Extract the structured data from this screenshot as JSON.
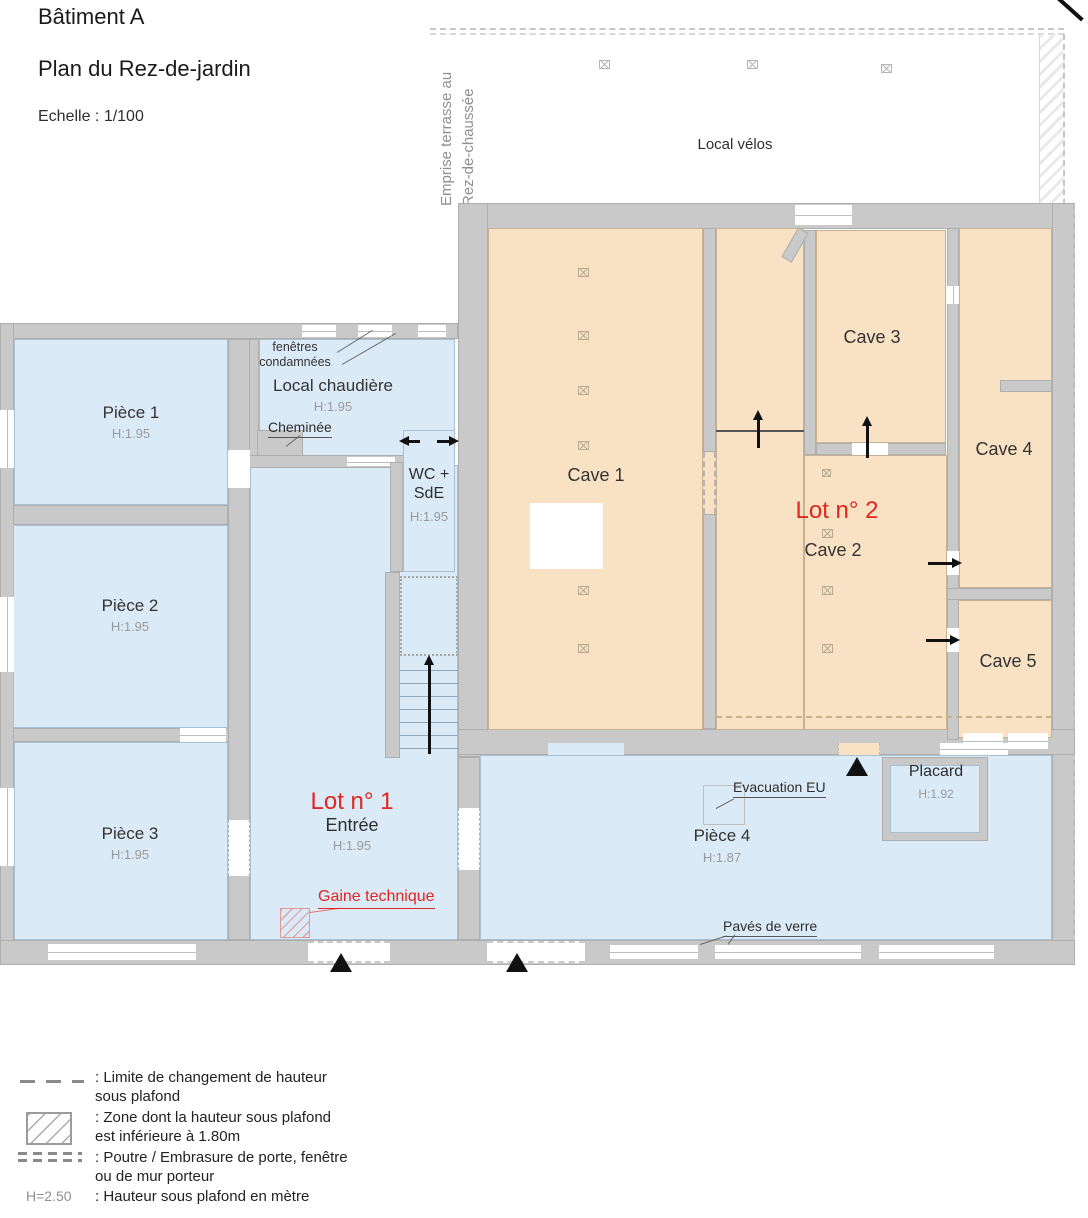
{
  "title": {
    "line1": "Bâtiment A",
    "line2": "Plan du Rez-de-jardin",
    "scale": "Echelle : 1/100"
  },
  "terrace": {
    "edge_label": "Emprise terrasse au\nRez-de-chaussée",
    "room_label": "Local vélos"
  },
  "lots": {
    "lot1": "Lot n° 1",
    "lot2": "Lot n° 2"
  },
  "rooms": {
    "piece1": {
      "name": "Pièce 1",
      "height": "H:1.95"
    },
    "piece2": {
      "name": "Pièce 2",
      "height": "H:1.95"
    },
    "piece3": {
      "name": "Pièce 3",
      "height": "H:1.95"
    },
    "piece4": {
      "name": "Pièce 4",
      "height": "H:1.87"
    },
    "local_chaudiere": {
      "name": "Local chaudière",
      "height": "H:1.95"
    },
    "wc": {
      "name": "WC +\nSdE",
      "height": "H:1.95"
    },
    "entree": {
      "name": "Entrée",
      "height": "H:1.95"
    },
    "placard": {
      "name": "Placard",
      "height": "H:1.92"
    },
    "cave1": {
      "name": "Cave 1"
    },
    "cave2": {
      "name": "Cave 2"
    },
    "cave3": {
      "name": "Cave 3"
    },
    "cave4": {
      "name": "Cave 4"
    },
    "cave5": {
      "name": "Cave 5"
    }
  },
  "annotations": {
    "fenetres_condamnees": "fenêtres\ncondamnées",
    "cheminee": "Cheminée",
    "evacuation": "Evacuation EU",
    "paves": "Pavés de verre",
    "gaine": "Gaine technique"
  },
  "legend": {
    "items": [
      {
        "symbol": "dash-line",
        "label": ": Limite de changement de hauteur\nsous plafond"
      },
      {
        "symbol": "hatch-box",
        "label": ": Zone dont la hauteur sous plafond\nest inférieure à 1.80m"
      },
      {
        "symbol": "double-dash",
        "label": ": Poutre / Embrasure de porte, fenêtre\nou de mur porteur"
      },
      {
        "symbol": "height-code",
        "symbol_text": "H=2.50",
        "label": ": Hauteur sous plafond en mètre"
      }
    ]
  },
  "colors": {
    "wall": "#c9c9c9",
    "room_blue": "#dbeaf7",
    "cave_beige": "#f9e2c3",
    "accent_red": "#e0261f",
    "muted_text": "#9a9a9a",
    "dark_text": "#2e2e2e"
  }
}
